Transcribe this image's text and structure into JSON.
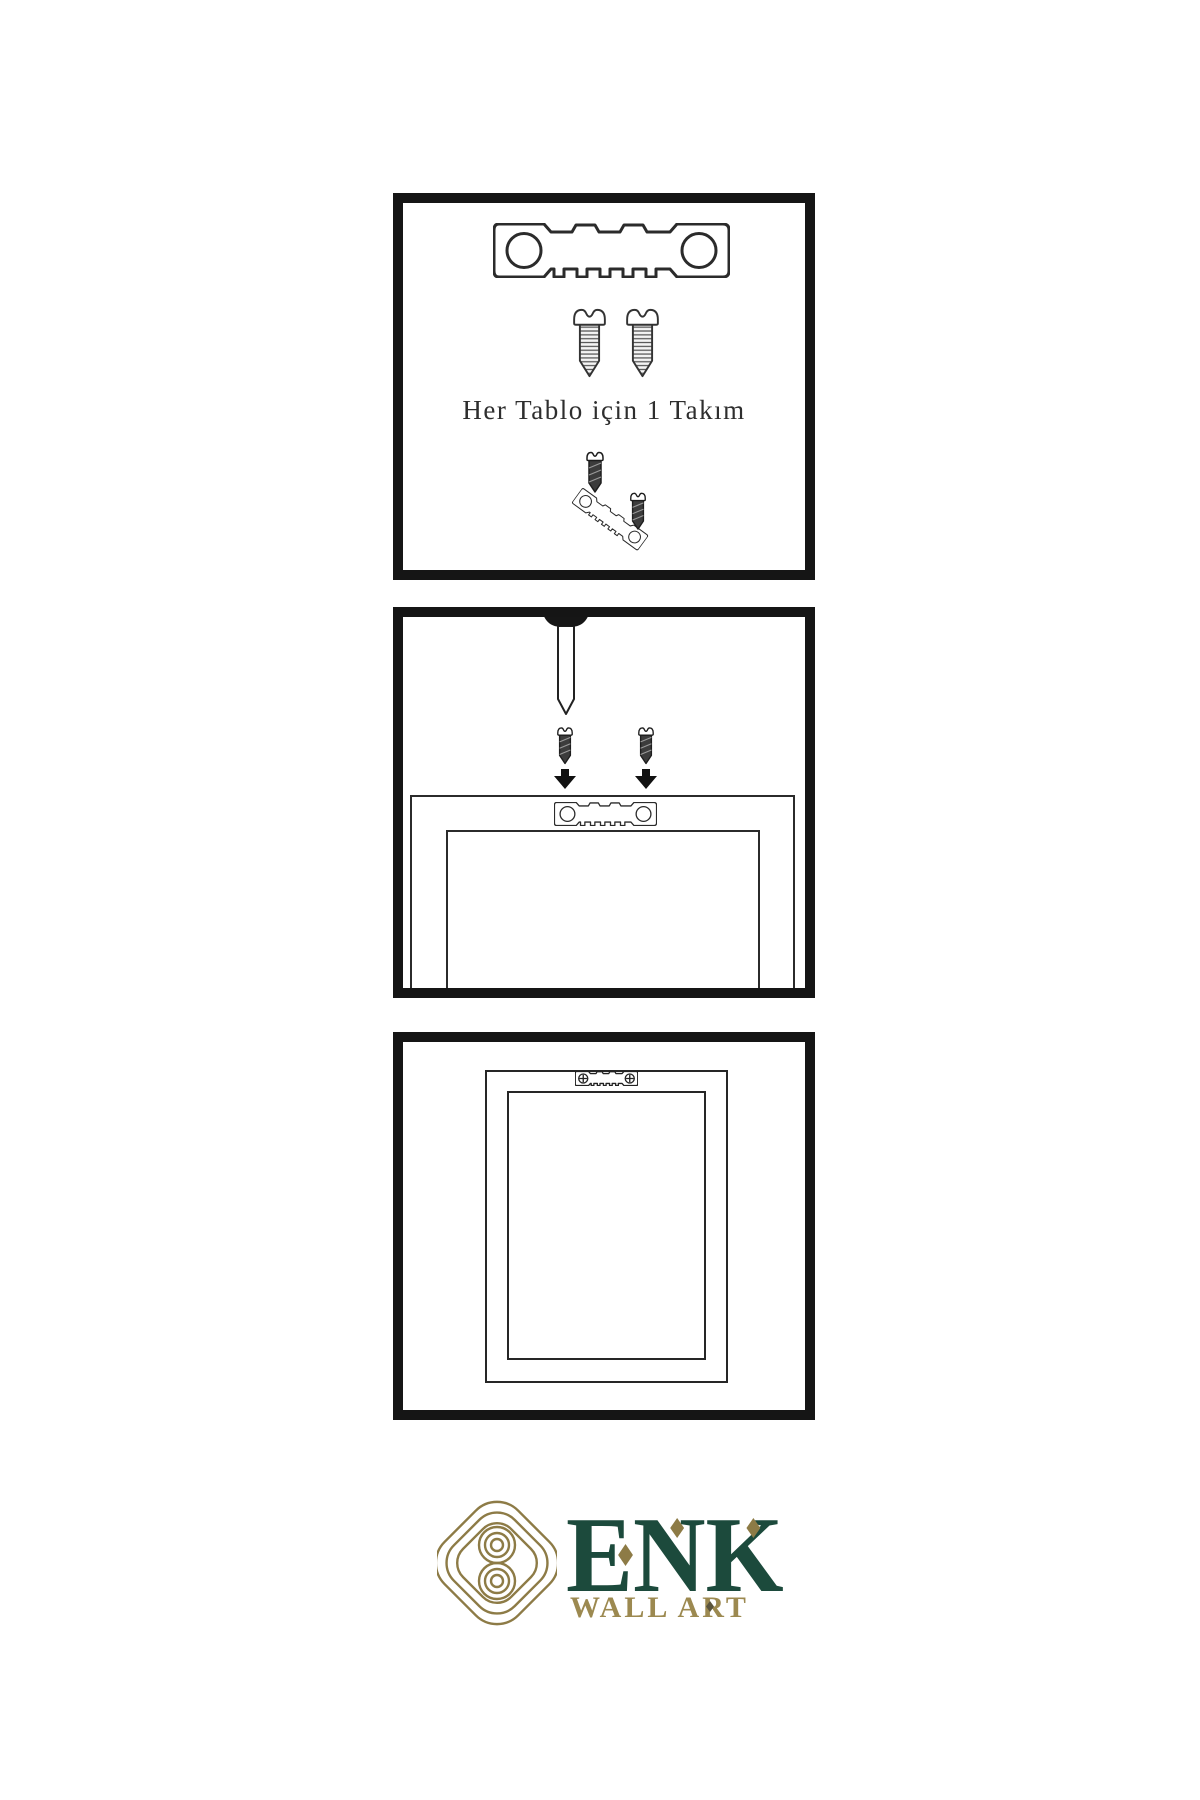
{
  "document": {
    "background": "#ffffff",
    "type": "wall-art-hanging-instructions"
  },
  "panels": [
    {
      "name": "hardware-set",
      "caption": "Her Tablo için 1 Takım",
      "icons": [
        "sawtooth-hanger-icon",
        "screw-icon",
        "screw-icon",
        "screw-icon",
        "tilted-sawtooth-hanger-icon",
        "screw-icon"
      ]
    },
    {
      "name": "mount-hanger-on-frame-back",
      "icons": [
        "wall-nail-icon",
        "dark-screw-icon",
        "dark-screw-icon",
        "down-arrow-icon",
        "down-arrow-icon",
        "frame-back-outline",
        "sawtooth-hanger-icon"
      ]
    },
    {
      "name": "frame-hung-on-wall",
      "icons": [
        "frame-outline",
        "sawtooth-hanger-with-screws-icon"
      ]
    }
  ],
  "logo": {
    "brand": "ENK",
    "subtitle": "WALL ART",
    "symbol": "celtic-knot-icon"
  },
  "colors": {
    "panel_border": "#151515",
    "line_art": "#2b2b2b",
    "logo_green": "#1c4a3c",
    "logo_gold": "#8d7b46",
    "subtitle_gold": "#9c8950"
  }
}
